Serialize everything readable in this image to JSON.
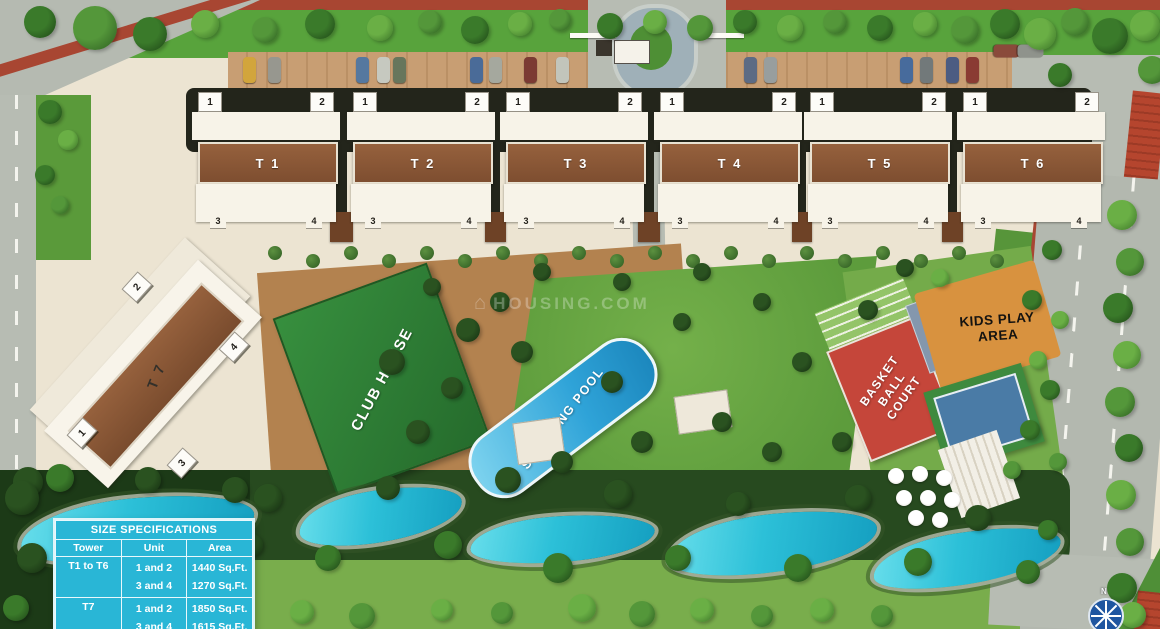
{
  "colors": {
    "table_cyan": "#29b6d6",
    "water": "#2cc0d8",
    "track_red": "#a84632",
    "court_red": "#c5463a",
    "club_green": "#2f7c36",
    "lawn_green": "#66a33e",
    "roof_brown": "#96613d",
    "kids_orange": "#d8923f",
    "road_gray": "#b7bcb3"
  },
  "site": {
    "towers": [
      {
        "label": "T 1",
        "top_units": [
          "1",
          "2"
        ],
        "bottom_units": [
          "3",
          "4"
        ]
      },
      {
        "label": "T 2",
        "top_units": [
          "1",
          "2"
        ],
        "bottom_units": [
          "3",
          "4"
        ]
      },
      {
        "label": "T 3",
        "top_units": [
          "1",
          "2"
        ],
        "bottom_units": [
          "3",
          "4"
        ]
      },
      {
        "label": "T 4",
        "top_units": [
          "1",
          "2"
        ],
        "bottom_units": [
          "3",
          "4"
        ]
      },
      {
        "label": "T 5",
        "top_units": [
          "1",
          "2"
        ],
        "bottom_units": [
          "3",
          "4"
        ]
      },
      {
        "label": "T 6",
        "top_units": [
          "1",
          "2"
        ],
        "bottom_units": [
          "3",
          "4"
        ]
      }
    ],
    "tower7": {
      "label": "T 7",
      "units": [
        "1",
        "2",
        "3",
        "4"
      ]
    },
    "amenities": {
      "club_house": "CLUB HOUSE",
      "swimming_pool": "SWIMMING POOL",
      "basketball_court": "BASKET BALL COURT",
      "kids_play_area": "KIDS PLAY AREA"
    },
    "compass_label": "N",
    "watermark": "HOUSING.COM"
  },
  "spec_table": {
    "title": "SIZE SPECIFICATIONS",
    "columns": [
      "Tower",
      "Unit",
      "Area"
    ],
    "groups": [
      {
        "tower": "T1 to T6",
        "rows": [
          {
            "unit": "1 and 2",
            "area": "1440 Sq.Ft."
          },
          {
            "unit": "3 and 4",
            "area": "1270 Sq.Ft."
          }
        ]
      },
      {
        "tower": "T7",
        "rows": [
          {
            "unit": "1 and 2",
            "area": "1850 Sq.Ft."
          },
          {
            "unit": "3 and 4",
            "area": "1615 Sq.Ft."
          }
        ]
      }
    ]
  }
}
